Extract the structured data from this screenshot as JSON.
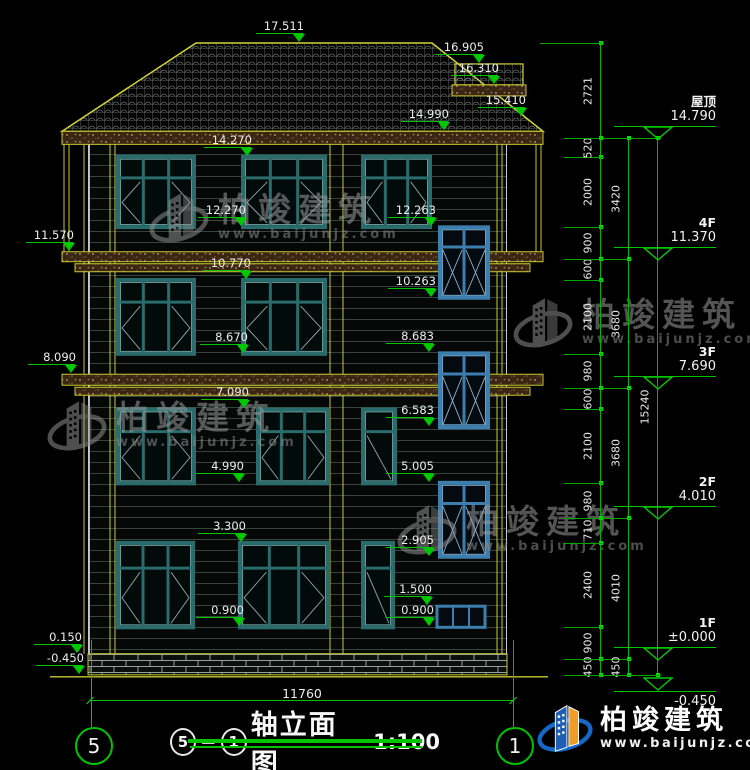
{
  "drawing": {
    "title": {
      "prefix_axis": "5",
      "suffix_axis": "1",
      "name": "轴立面图",
      "scale": "1:100"
    },
    "axis_bubbles": {
      "left": "5",
      "right": "1"
    },
    "bottom_dimension": "11760",
    "floor_markers": [
      {
        "name": "屋顶",
        "value": "14.790",
        "level": 14.79
      },
      {
        "name": "4F",
        "value": "11.370",
        "level": 11.37
      },
      {
        "name": "3F",
        "value": "7.690",
        "level": 7.69
      },
      {
        "name": "2F",
        "value": "4.010",
        "level": 4.01
      },
      {
        "name": "1F",
        "value": "±0.000",
        "level": 0.0
      },
      {
        "name": "",
        "value": "-0.450",
        "level": -0.45,
        "text_below": true
      }
    ],
    "level_markers": [
      {
        "label": "17.511",
        "level": 17.511,
        "x": 300
      },
      {
        "label": "16.905",
        "level": 16.905,
        "x": 480
      },
      {
        "label": "16.310",
        "level": 16.31,
        "x": 495
      },
      {
        "label": "15.410",
        "level": 15.41,
        "x": 522
      },
      {
        "label": "14.990",
        "level": 14.99,
        "x": 445
      },
      {
        "label": "14.270",
        "level": 14.27,
        "x": 248
      },
      {
        "label": "12.270",
        "level": 12.27,
        "x": 242
      },
      {
        "label": "12.263",
        "level": 12.263,
        "x": 432
      },
      {
        "label": "11.570",
        "level": 11.57,
        "x": 70
      },
      {
        "label": "10.770",
        "level": 10.77,
        "x": 247
      },
      {
        "label": "10.263",
        "level": 10.263,
        "x": 432
      },
      {
        "label": "8.670",
        "level": 8.67,
        "x": 244
      },
      {
        "label": "8.683",
        "level": 8.683,
        "x": 430
      },
      {
        "label": "8.090",
        "level": 8.09,
        "x": 72
      },
      {
        "label": "7.090",
        "level": 7.09,
        "x": 245
      },
      {
        "label": "6.583",
        "level": 6.583,
        "x": 430
      },
      {
        "label": "4.990",
        "level": 4.99,
        "x": 240
      },
      {
        "label": "5.005",
        "level": 5.005,
        "x": 430
      },
      {
        "label": "3.300",
        "level": 3.3,
        "x": 242
      },
      {
        "label": "2.905",
        "level": 2.905,
        "x": 430
      },
      {
        "label": "1.500",
        "level": 1.5,
        "x": 428
      },
      {
        "label": "0.900",
        "level": 0.9,
        "x": 240
      },
      {
        "label": "0.900",
        "level": 0.9,
        "x": 430
      },
      {
        "label": "0.150",
        "level": 0.15,
        "x": 78
      },
      {
        "label": "-0.450",
        "level": -0.45,
        "x": 80
      }
    ],
    "right_dim_chains": [
      {
        "x": 600,
        "boundaries": [
          17.511,
          14.79,
          14.27,
          12.27,
          11.37,
          10.77,
          8.67,
          7.69,
          7.09,
          4.99,
          4.01,
          3.3,
          0.9,
          0.0,
          -0.45
        ],
        "labels": [
          "2721",
          "520",
          "2000",
          "900",
          "600",
          "2100",
          "980",
          "600",
          "2100",
          "980",
          "710",
          "2400",
          "900",
          "450"
        ]
      },
      {
        "x": 628,
        "boundaries": [
          14.79,
          11.37,
          7.69,
          4.01,
          0.0,
          -0.45
        ],
        "labels": [
          "3420",
          "3680",
          "3680",
          "4010",
          "450"
        ]
      },
      {
        "x": 657,
        "boundaries": [
          14.79,
          -0.45
        ],
        "labels": [
          "15240"
        ]
      }
    ]
  },
  "watermark": {
    "brand": "柏竣建筑",
    "url": "www.baijunjz.com"
  },
  "logo": {
    "brand": "柏竣建筑",
    "url": "www.baijunjz.com"
  },
  "colors": {
    "dimension_green": "#00C400",
    "cad_yellow": "#C8C832",
    "window_teal": "#2A6B6B",
    "stair_window_blue": "#3C7FAE",
    "band_brown": "#3A2614",
    "text_white": "#EDEDED"
  }
}
